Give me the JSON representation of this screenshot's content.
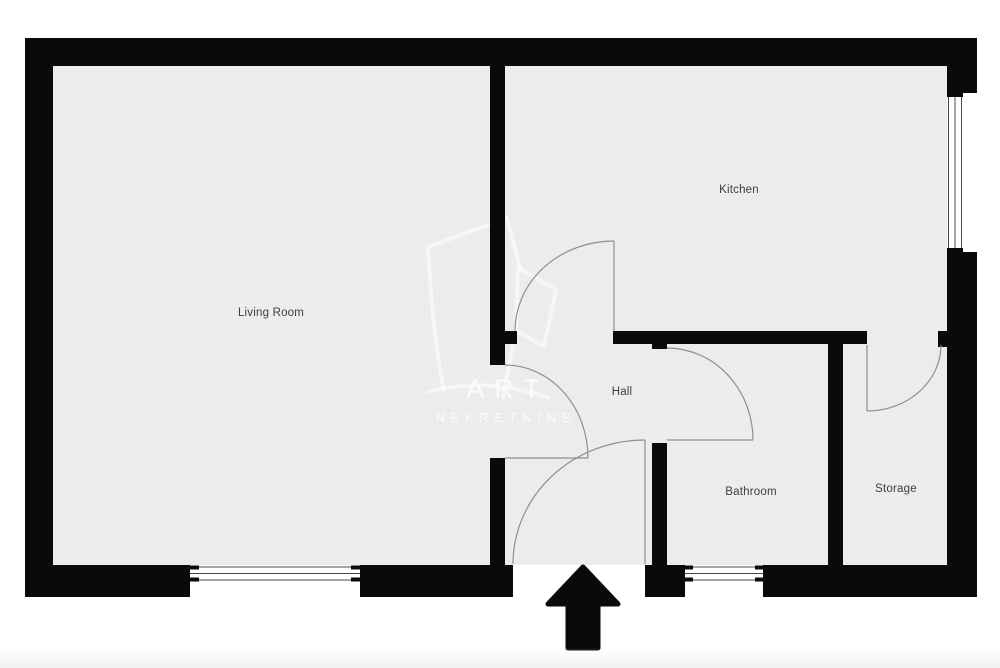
{
  "floorplan": {
    "rooms": {
      "living_room": {
        "label": "Living Room"
      },
      "kitchen": {
        "label": "Kitchen"
      },
      "hall": {
        "label": "Hall"
      },
      "bathroom": {
        "label": "Bathroom"
      },
      "storage": {
        "label": "Storage"
      }
    },
    "watermark": {
      "line1": "ART",
      "line2": "NEKRETNINE"
    },
    "colors": {
      "wall": "#0a0a0a",
      "floor": "#ebecec",
      "door_stroke": "#8f8f8f",
      "window_line": "#4a4a4a",
      "window_fill": "#ffffff",
      "label_text": "#3e3e3e"
    }
  }
}
